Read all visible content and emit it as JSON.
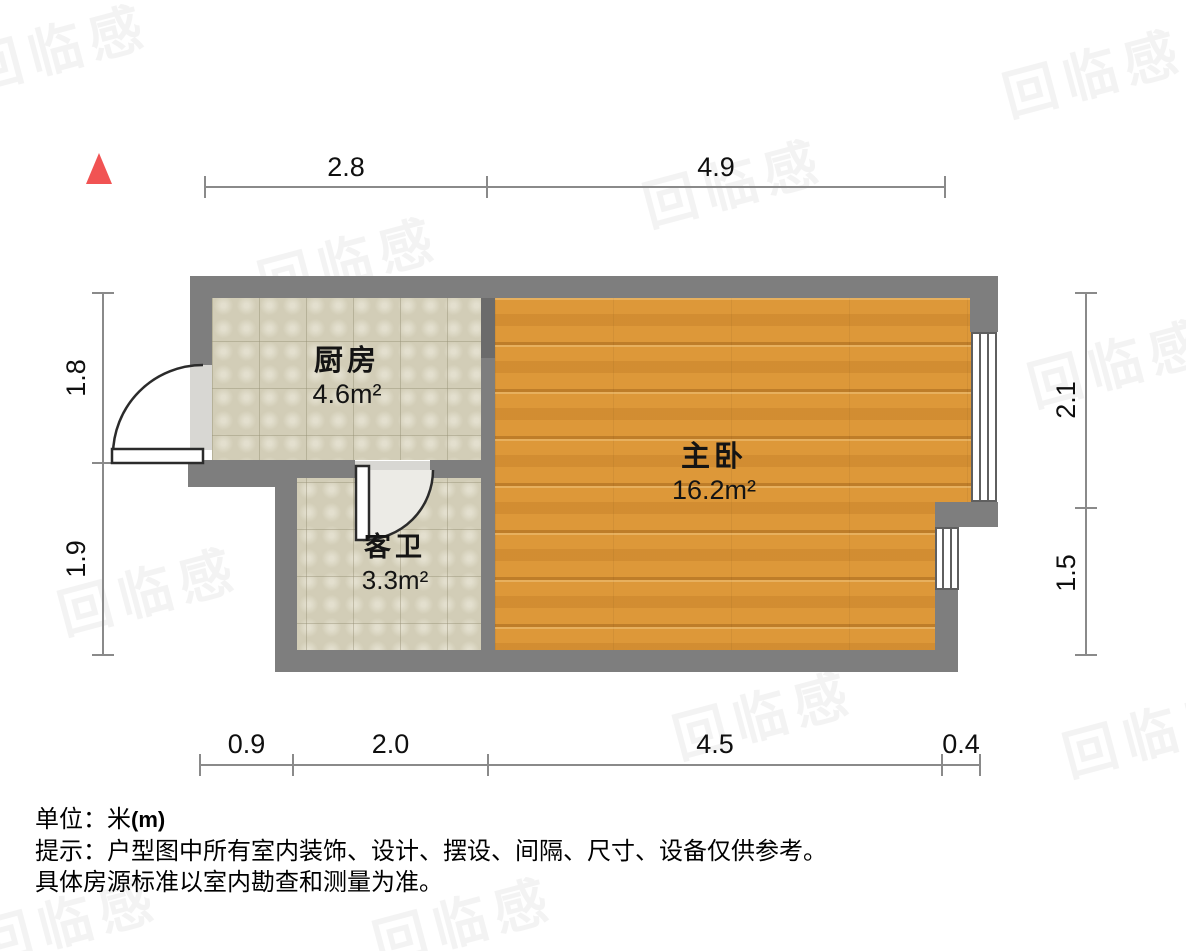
{
  "document": {
    "type": "floor-plan"
  },
  "rooms": [
    {
      "id": "kitchen",
      "name": "厨房",
      "area": "4.6m²"
    },
    {
      "id": "guest-bathroom",
      "name": "客卫",
      "area": "3.3m²"
    },
    {
      "id": "master-bedroom",
      "name": "主卧",
      "area": "16.2m²"
    }
  ],
  "dimensions": {
    "top": [
      "2.8",
      "4.9"
    ],
    "bottom": [
      "0.9",
      "2.0",
      "4.5",
      "0.4"
    ],
    "left": [
      "1.8",
      "1.9"
    ],
    "right": [
      "2.1",
      "1.5"
    ]
  },
  "footer": {
    "unit_label": "单位：米",
    "unit_suffix": "(m)",
    "tip_line1": "提示：户型图中所有室内装饰、设计、摆设、间隔、尺寸、设备仅供参考。",
    "tip_line2": "具体房源标准以室内勘查和测量为准。"
  },
  "watermark": {
    "text": "回临感"
  },
  "colors": {
    "wall": "#7e7e7e",
    "tile_floor": "#d9d4bd",
    "wood_floor": "#dd9839",
    "north_red": "#f15353",
    "dimension_line": "#8a8a8a",
    "text": "#0f0f0f"
  }
}
